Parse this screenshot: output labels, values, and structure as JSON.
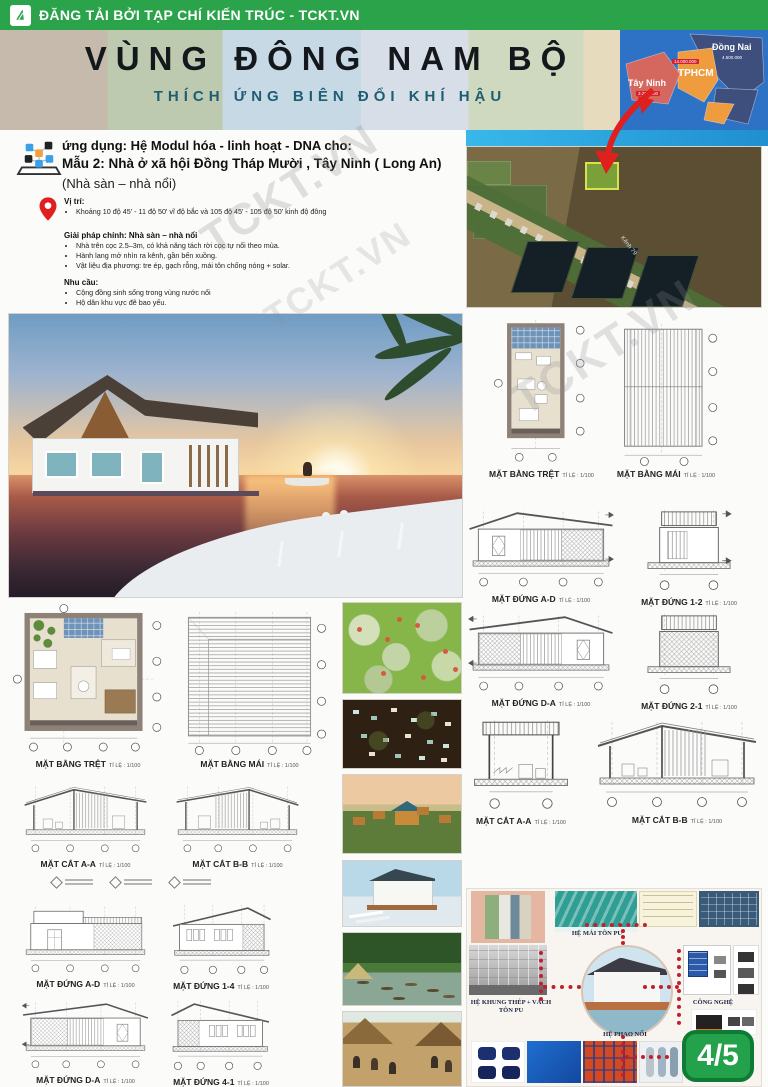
{
  "header": {
    "publisher": "ĐĂNG TẢI BỞI TẠP CHÍ KIẾN TRÚC - TCKT.VN"
  },
  "banner": {
    "title": "VÙNG ĐÔNG NAM BỘ",
    "subtitle": "THÍCH ỨNG BIÊN ĐỔI KHÍ HẬU",
    "map": {
      "provinces": [
        {
          "name": "Đồng Nai",
          "population": "4.500.000"
        },
        {
          "name": "TPHCM",
          "population": "14.000.000"
        },
        {
          "name": "Tây Ninh",
          "population": "3.200.000"
        }
      ]
    }
  },
  "intro": {
    "application_line": "ứng dụng: Hệ Modul hóa - linh hoạt - DNA cho:",
    "model_line": "Mẫu 2: Nhà ở xã hội Đồng Tháp Mười , Tây Ninh ( Long An)",
    "type_line": "(Nhà sàn – nhà nổi)",
    "location": {
      "title": "Vị trí:",
      "items": [
        "Khoảng 10 độ 45' - 11 độ 50' vĩ độ bắc và 105 độ 45' - 105 độ 50' kinh độ đông"
      ]
    },
    "solution": {
      "title": "Giải pháp chính: Nhà sàn – nhà nổi",
      "items": [
        "Nhà trên cọc 2.5–3m, có khả năng tách rời cọc tự nổi theo mùa.",
        "Hành lang mở nhìn ra kênh, gần bến xuồng.",
        "Vật liệu địa phương: tre ép, gạch rỗng, mái tôn chống nóng + solar."
      ]
    },
    "needs": {
      "title": "Nhu cầu:",
      "items": [
        "Cộng đồng sinh sống trong vùng nước nổi",
        "Hộ dân khu vực đê bao yếu."
      ]
    }
  },
  "site": {
    "canal_label": "Kênh 79"
  },
  "drawings": {
    "right_plans": [
      {
        "label": "MẶT BẰNG TRỆT",
        "scale": "TỈ LỆ : 1/100"
      },
      {
        "label": "MẶT BẰNG MÁI",
        "scale": "TỈ LỆ : 1/100"
      }
    ],
    "right_elevations": [
      {
        "label": "MẶT ĐỨNG A-D",
        "scale": "TỈ LỆ : 1/100"
      },
      {
        "label": "MẶT ĐỨNG 1-2",
        "scale": "TỈ LỆ : 1/100"
      },
      {
        "label": "MẶT ĐỨNG D-A",
        "scale": "TỈ LỆ : 1/100"
      },
      {
        "label": "MẶT ĐỨNG 2-1",
        "scale": "TỈ LỆ : 1/100"
      }
    ],
    "right_sections": [
      {
        "label": "MẶT CẮT A-A",
        "scale": "TỈ LỆ : 1/100"
      },
      {
        "label": "MẶT CẮT B-B",
        "scale": "TỈ LỆ : 1/100"
      }
    ],
    "left_plans": [
      {
        "label": "MẶT BẰNG TRỆT",
        "scale": "TỈ LỆ : 1/100"
      },
      {
        "label": "MẶT BẰNG MÁI",
        "scale": "TỈ LỆ : 1/100"
      }
    ],
    "left_sections": [
      {
        "label": "MẶT CẮT A-A",
        "scale": "TỈ LỆ : 1/100"
      },
      {
        "label": "MẶT CẮT B-B",
        "scale": "TỈ LỆ : 1/100"
      }
    ],
    "left_elevations": [
      {
        "label": "MẶT ĐỨNG A-D",
        "scale": "TỈ LỆ : 1/100"
      },
      {
        "label": "MẶT ĐỨNG 1-4",
        "scale": "TỈ LỆ : 1/100"
      },
      {
        "label": "MẶT ĐỨNG D-A",
        "scale": "TỈ LỆ : 1/100"
      },
      {
        "label": "MẶT ĐỨNG 4-1",
        "scale": "TỈ LỆ : 1/100"
      }
    ]
  },
  "tech_diagram": {
    "roof_label": "HỆ MÁI TÔN PU",
    "frame_label": "HỆ KHUNG THÉP + VÁCH TÔN PU",
    "technology_label": "CÔNG NGHỆ",
    "float_label": "HỆ PHAO NỔI"
  },
  "page": {
    "badge": "4/5"
  },
  "watermark": "TCKT.VN",
  "colors": {
    "brand_green": "#2aa34b",
    "accent_red": "#d9232e",
    "map_blue": "#2f6fc4"
  }
}
